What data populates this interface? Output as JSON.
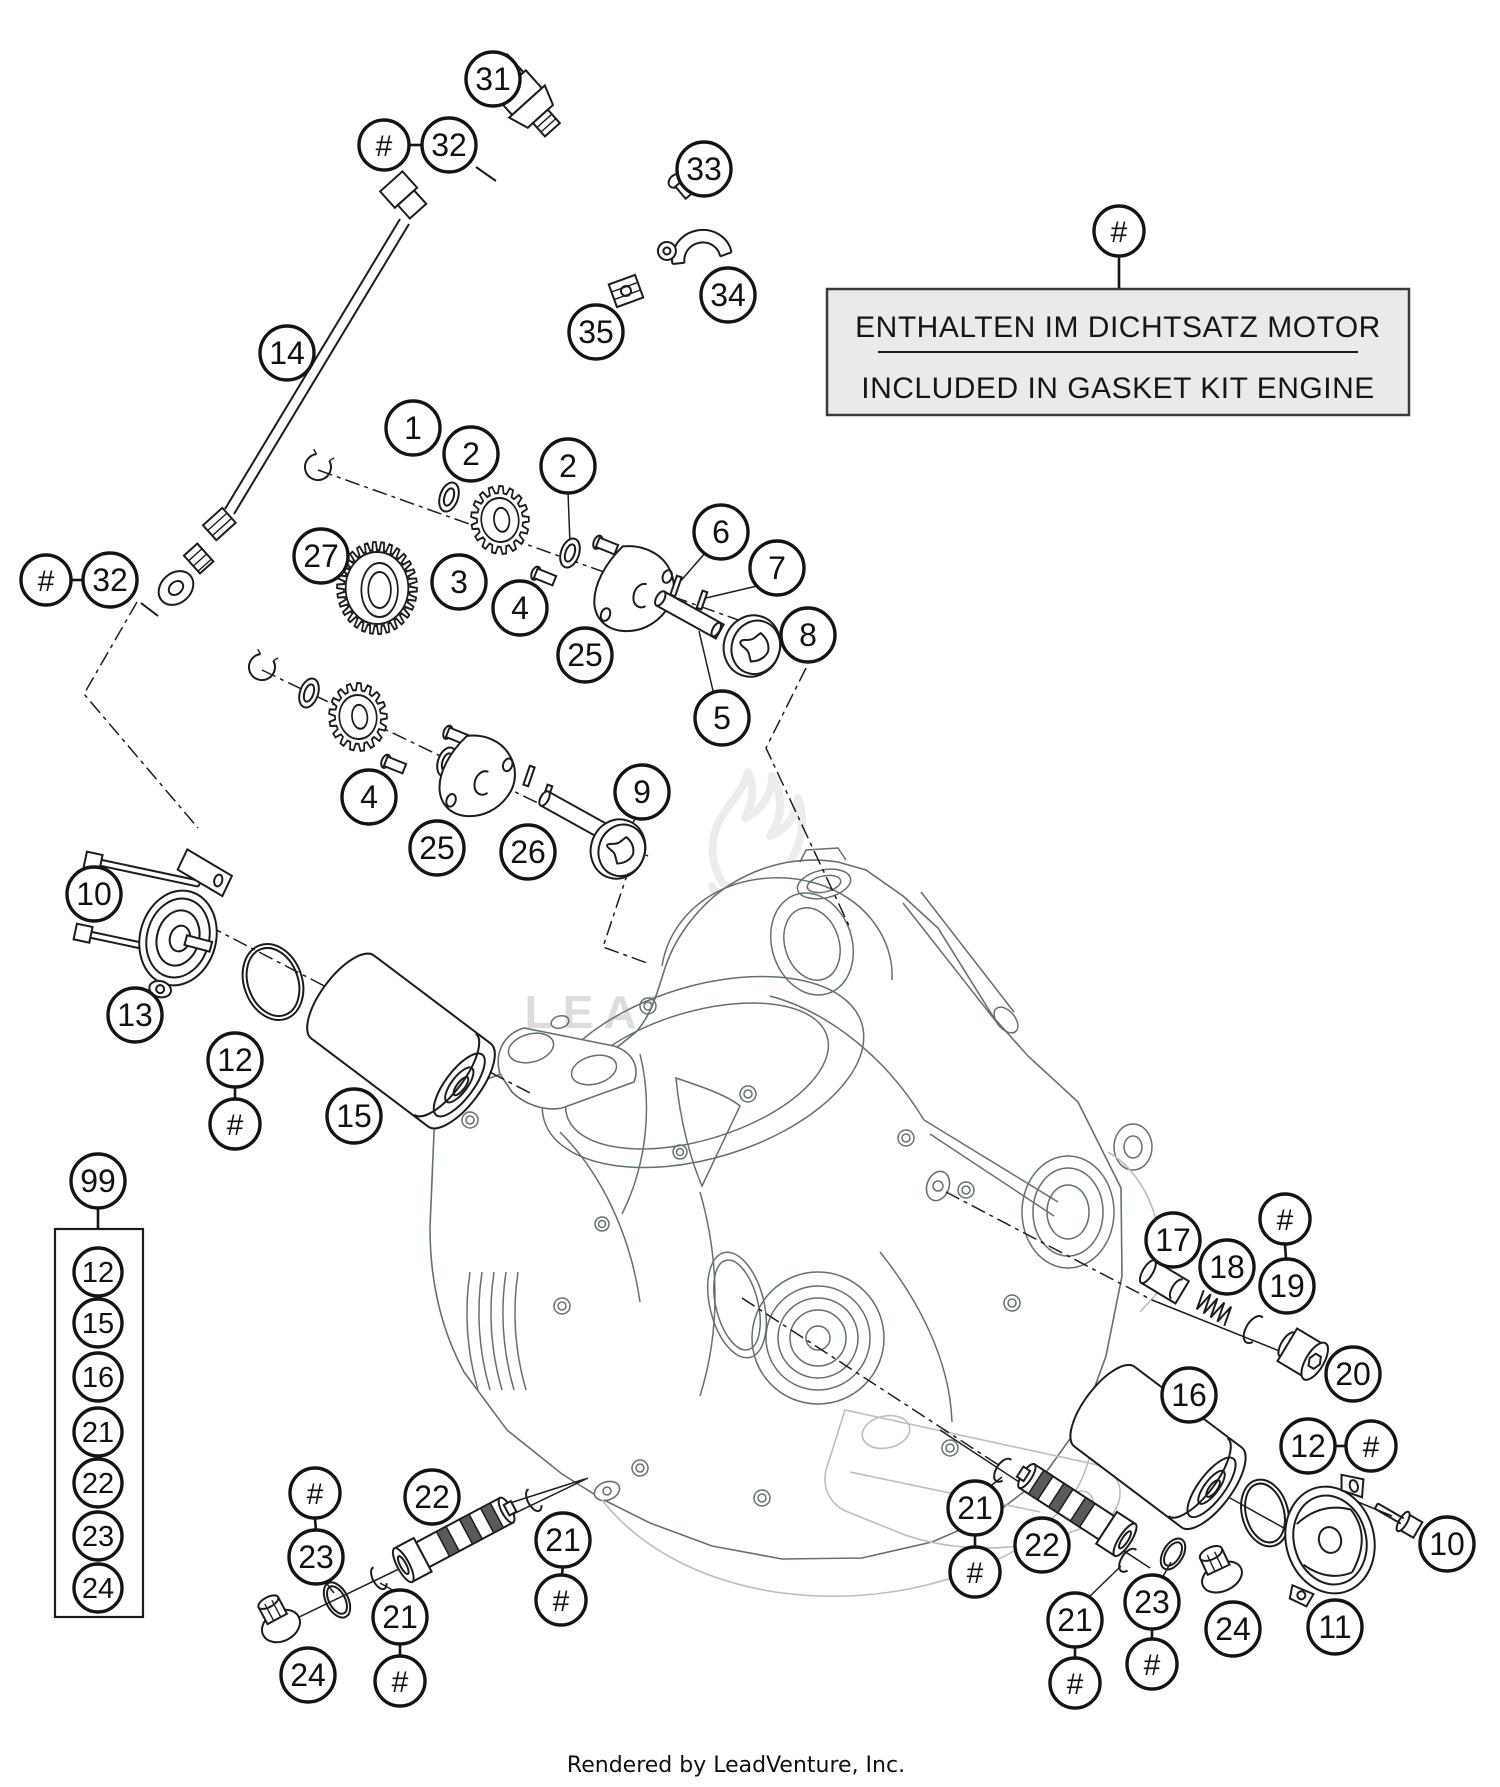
{
  "note": {
    "symbol": "#",
    "line1": "ENTHALTEN IM DICHTSATZ MOTOR",
    "line2": "INCLUDED IN GASKET KIT ENGINE"
  },
  "watermark": {
    "text": "LEADVENTURE"
  },
  "credit": "Rendered by LeadVenture, Inc.",
  "colors": {
    "background": "#ffffff",
    "part_line": "#1c1c1c",
    "engine_line": "#64716d",
    "engine_back_line": "#b9bfbc",
    "note_fill": "#e9ebe8",
    "note_border": "#3a3a3a",
    "watermark_gray": "#ececec"
  },
  "callouts": [
    {
      "label": "31",
      "x": 493,
      "y": 79
    },
    {
      "label": "#",
      "x": 384,
      "y": 145,
      "r": 25
    },
    {
      "label": "32",
      "x": 449,
      "y": 145
    },
    {
      "label": "33",
      "x": 704,
      "y": 169
    },
    {
      "label": "34",
      "x": 728,
      "y": 295
    },
    {
      "label": "35",
      "x": 596,
      "y": 332
    },
    {
      "label": "14",
      "x": 287,
      "y": 353
    },
    {
      "label": "#",
      "x": 1119,
      "y": 231,
      "r": 25
    },
    {
      "label": "1",
      "x": 413,
      "y": 428
    },
    {
      "label": "2",
      "x": 471,
      "y": 454
    },
    {
      "label": "2",
      "x": 568,
      "y": 466
    },
    {
      "label": "27",
      "x": 321,
      "y": 556
    },
    {
      "label": "3",
      "x": 459,
      "y": 582
    },
    {
      "label": "4",
      "x": 520,
      "y": 608
    },
    {
      "label": "6",
      "x": 721,
      "y": 532
    },
    {
      "label": "7",
      "x": 777,
      "y": 568
    },
    {
      "label": "8",
      "x": 808,
      "y": 635
    },
    {
      "label": "25",
      "x": 585,
      "y": 655
    },
    {
      "label": "5",
      "x": 722,
      "y": 718
    },
    {
      "label": "#",
      "x": 46,
      "y": 580,
      "r": 25
    },
    {
      "label": "32",
      "x": 110,
      "y": 580
    },
    {
      "label": "4",
      "x": 369,
      "y": 797
    },
    {
      "label": "25",
      "x": 437,
      "y": 848
    },
    {
      "label": "26",
      "x": 528,
      "y": 852
    },
    {
      "label": "9",
      "x": 642,
      "y": 792
    },
    {
      "label": "10",
      "x": 94,
      "y": 894
    },
    {
      "label": "13",
      "x": 135,
      "y": 1015
    },
    {
      "label": "12",
      "x": 235,
      "y": 1060
    },
    {
      "label": "#",
      "x": 235,
      "y": 1124,
      "r": 25
    },
    {
      "label": "15",
      "x": 354,
      "y": 1116
    },
    {
      "label": "17",
      "x": 1173,
      "y": 1240
    },
    {
      "label": "18",
      "x": 1227,
      "y": 1267
    },
    {
      "label": "#",
      "x": 1285,
      "y": 1219,
      "r": 25
    },
    {
      "label": "19",
      "x": 1287,
      "y": 1286
    },
    {
      "label": "20",
      "x": 1353,
      "y": 1374
    },
    {
      "label": "16",
      "x": 1189,
      "y": 1395
    },
    {
      "label": "12",
      "x": 1308,
      "y": 1446
    },
    {
      "label": "#",
      "x": 1371,
      "y": 1446,
      "r": 25
    },
    {
      "label": "10",
      "x": 1447,
      "y": 1544
    },
    {
      "label": "11",
      "x": 1335,
      "y": 1627
    },
    {
      "label": "24",
      "x": 1233,
      "y": 1629
    },
    {
      "label": "23",
      "x": 1152,
      "y": 1602
    },
    {
      "label": "#",
      "x": 1152,
      "y": 1664,
      "r": 25
    },
    {
      "label": "21",
      "x": 1075,
      "y": 1620
    },
    {
      "label": "#",
      "x": 1075,
      "y": 1683,
      "r": 25
    },
    {
      "label": "22",
      "x": 1042,
      "y": 1545
    },
    {
      "label": "21",
      "x": 975,
      "y": 1508
    },
    {
      "label": "#",
      "x": 975,
      "y": 1572,
      "r": 25
    },
    {
      "label": "#",
      "x": 315,
      "y": 1493,
      "r": 25
    },
    {
      "label": "23",
      "x": 316,
      "y": 1557
    },
    {
      "label": "22",
      "x": 432,
      "y": 1497
    },
    {
      "label": "21",
      "x": 563,
      "y": 1540
    },
    {
      "label": "#",
      "x": 561,
      "y": 1600,
      "r": 25
    },
    {
      "label": "21",
      "x": 400,
      "y": 1617
    },
    {
      "label": "#",
      "x": 400,
      "y": 1681,
      "r": 25
    },
    {
      "label": "24",
      "x": 308,
      "y": 1675
    }
  ],
  "kit_box": {
    "label": "99",
    "x": 98,
    "y": 1181,
    "box": {
      "x": 55,
      "y": 1229,
      "w": 88,
      "h": 388
    },
    "items": [
      {
        "label": "12",
        "x": 98,
        "y": 1272
      },
      {
        "label": "15",
        "x": 98,
        "y": 1323
      },
      {
        "label": "16",
        "x": 98,
        "y": 1377
      },
      {
        "label": "21",
        "x": 98,
        "y": 1432
      },
      {
        "label": "22",
        "x": 98,
        "y": 1483
      },
      {
        "label": "23",
        "x": 98,
        "y": 1536
      },
      {
        "label": "24",
        "x": 98,
        "y": 1588
      }
    ]
  }
}
